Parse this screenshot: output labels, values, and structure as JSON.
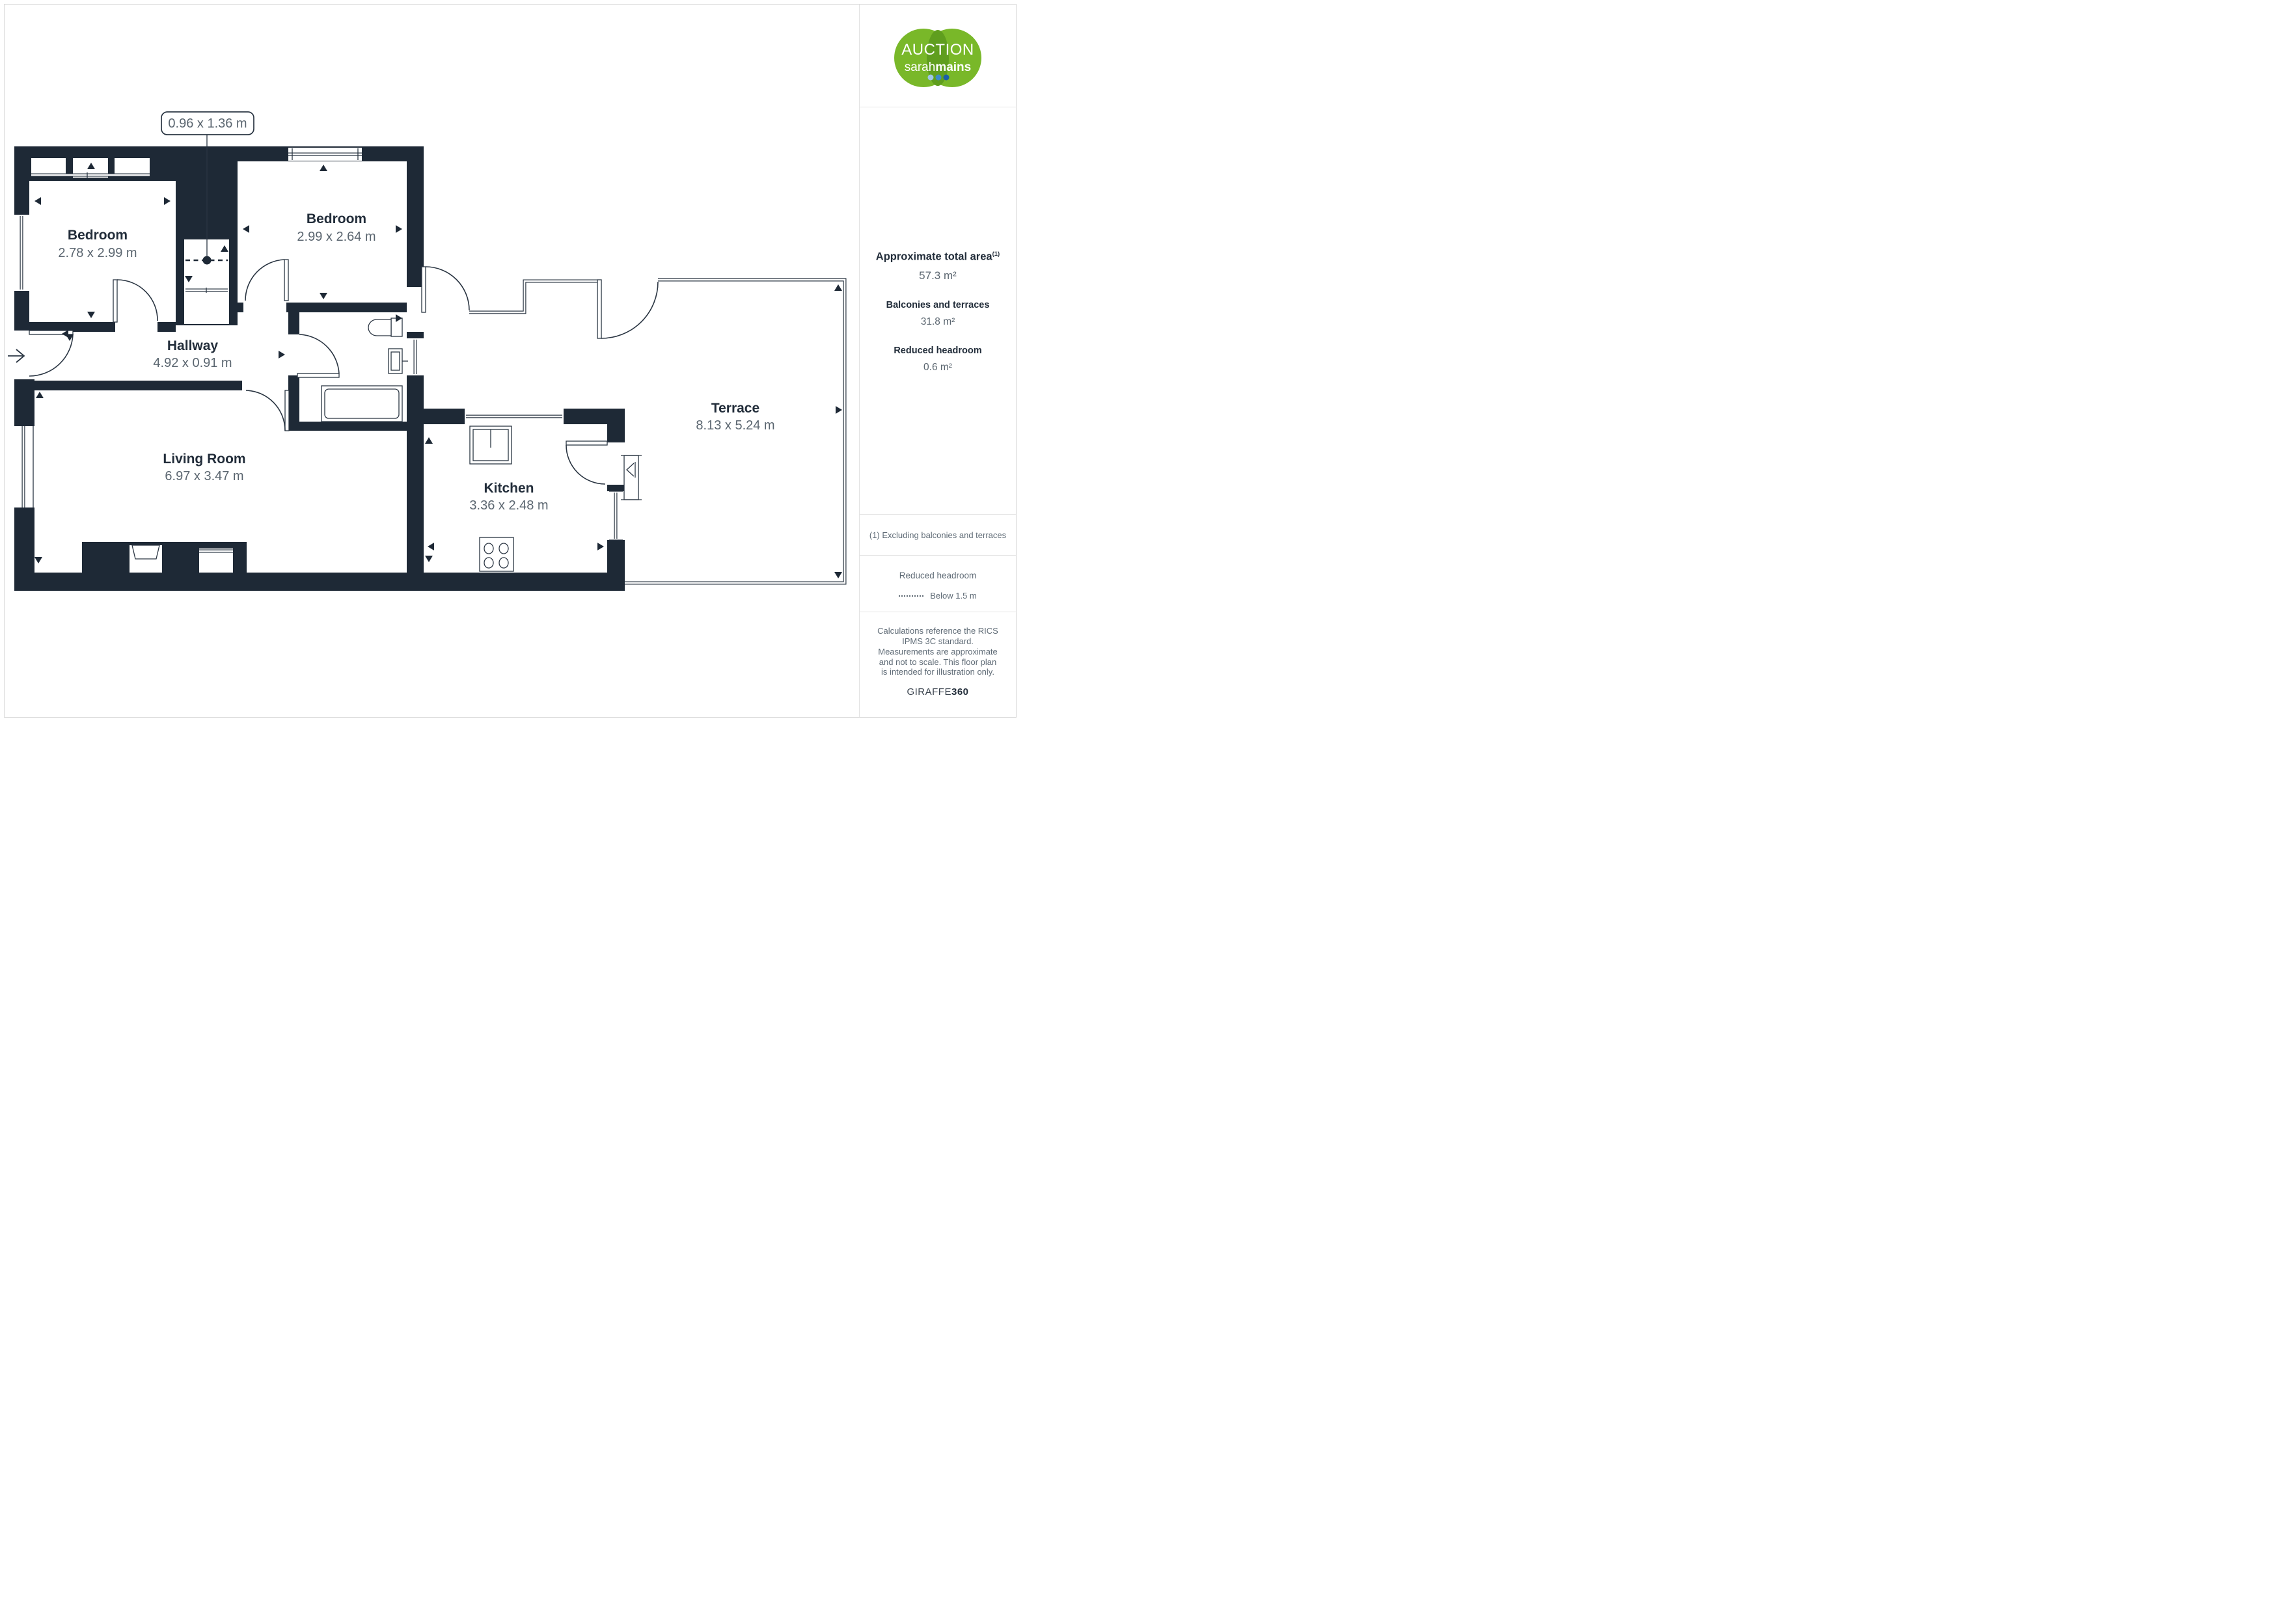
{
  "logo": {
    "line1": "AUCTION",
    "line2_light": "sarah",
    "line2_bold": "mains"
  },
  "plan": {
    "dimension_callout": "0.96 x 1.36 m",
    "rooms": [
      {
        "name": "Bedroom",
        "dims": "2.78 x 2.99 m"
      },
      {
        "name": "Bedroom",
        "dims": "2.99 x 2.64 m"
      },
      {
        "name": "Hallway",
        "dims": "4.92 x 0.91 m"
      },
      {
        "name": "Living Room",
        "dims": "6.97 x 3.47 m"
      },
      {
        "name": "Kitchen",
        "dims": "3.36 x 2.48 m"
      },
      {
        "name": "Terrace",
        "dims": "8.13 x 5.24 m"
      }
    ]
  },
  "sidebar": {
    "total_area_label": "Approximate total area",
    "total_area_sup": "(1)",
    "total_area_value": "57.3 m²",
    "balconies_label": "Balconies and terraces",
    "balconies_value": "31.8 m²",
    "headroom_label": "Reduced headroom",
    "headroom_value": "0.6 m²",
    "note": "(1) Excluding balconies and terraces",
    "legend_title": "Reduced headroom",
    "legend_value": "Below 1.5 m",
    "disclaimer": "Calculations reference the RICS IPMS 3C standard. Measurements are approximate and not to scale. This floor plan is intended for illustration only.",
    "brand": "GIRAFFE",
    "brand_bold": "360"
  },
  "colors": {
    "wall": "#1e2936",
    "logo_green": "#79b829",
    "logo_green_dark": "#5f9e1e",
    "dot_light": "#9fc7e8",
    "dot_mid": "#3e8bc8",
    "dot_dark": "#1a5fa8"
  }
}
